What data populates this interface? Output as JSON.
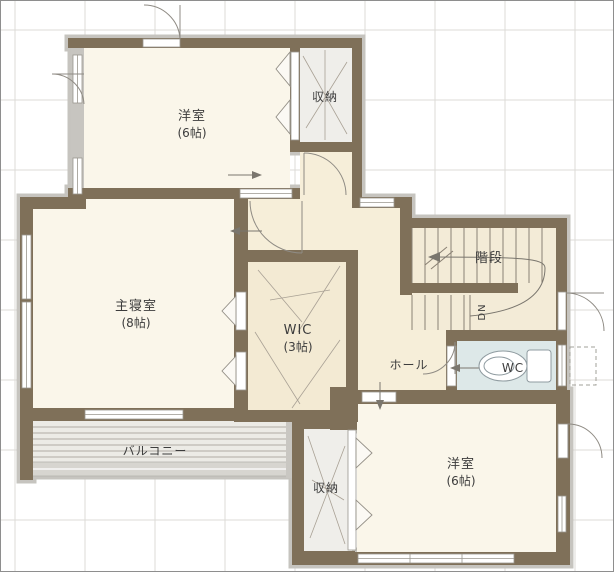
{
  "plan": {
    "title": "2F floor plan",
    "rooms": {
      "bedroom_top": {
        "name": "洋室",
        "size": "(6帖)"
      },
      "closet_top": {
        "name": "収納"
      },
      "master_bedroom": {
        "name": "主寝室",
        "size": "(8帖)"
      },
      "wic": {
        "name": "WIC",
        "size": "(3帖)"
      },
      "stairs": {
        "name": "階段"
      },
      "stairs_direction": "DN",
      "hall": {
        "name": "ホール"
      },
      "wc": {
        "name": "WC"
      },
      "balcony": {
        "name": "バルコニー"
      },
      "closet_bottom": {
        "name": "収納"
      },
      "bedroom_bottom": {
        "name": "洋室",
        "size": "(6帖)"
      }
    },
    "colors": {
      "wall": "#7f7059",
      "wall_shadow": "#c6c4bf",
      "floor_room": "#faf6ea",
      "floor_hall": "#f6eed9",
      "floor_stairs": "#f3ebd7",
      "floor_wic": "#f3ead3",
      "floor_closet": "#efeeea",
      "floor_wc": "#dde8e8",
      "balcony_floor": "#ecebe6",
      "balcony_rail": "#d7d5d0",
      "grid_line": "#dcdbd7"
    }
  }
}
